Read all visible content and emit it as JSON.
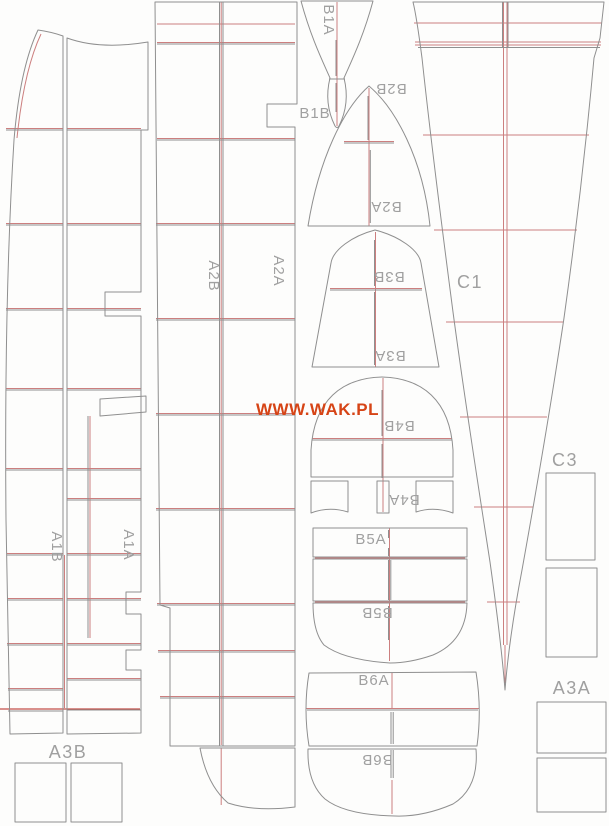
{
  "sheet": {
    "watermark": "WWW.WAK.PL",
    "background": "#fdfdfc"
  },
  "colors": {
    "outline": "#8f8f8f",
    "accent": "#cc7f7f",
    "accent_strong": "#c4504a",
    "label": "#a0a0a0",
    "watermark": "#d64416"
  },
  "parts": {
    "a1b": {
      "label": "A1B"
    },
    "a1a": {
      "label": "A1A"
    },
    "a2b": {
      "label": "A2B"
    },
    "a2a": {
      "label": "A2A"
    },
    "a3a": {
      "label": "A3A"
    },
    "a3b": {
      "label": "A3B"
    },
    "b1a": {
      "label": "B1A"
    },
    "b1b": {
      "label": "B1B"
    },
    "b2a": {
      "label": "B2A"
    },
    "b2b": {
      "label": "B2B"
    },
    "b3a": {
      "label": "B3A"
    },
    "b3b": {
      "label": "B3B"
    },
    "b4a": {
      "label": "B4A"
    },
    "b4b": {
      "label": "B4B"
    },
    "b5a": {
      "label": "B5A"
    },
    "b5b": {
      "label": "B5B"
    },
    "b6a": {
      "label": "B6A"
    },
    "b6b": {
      "label": "B6B"
    },
    "c1": {
      "label": "C1"
    },
    "c3": {
      "label": "C3"
    }
  }
}
